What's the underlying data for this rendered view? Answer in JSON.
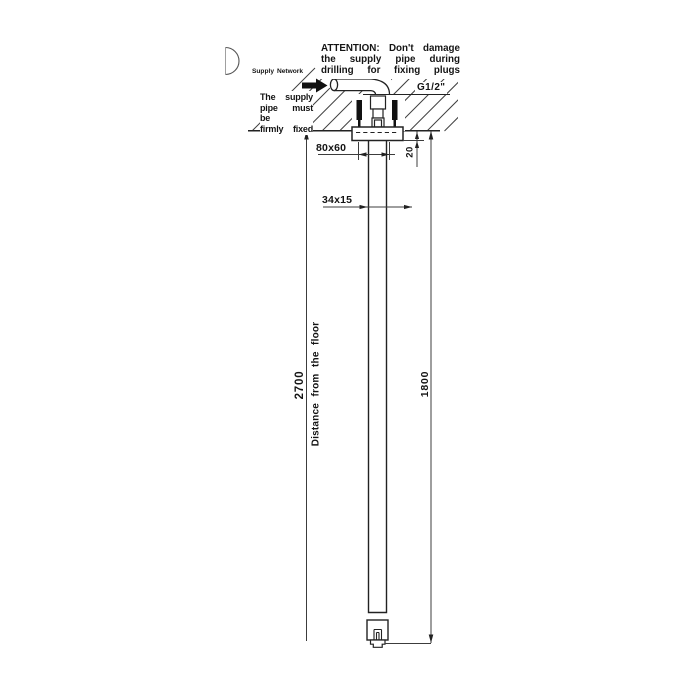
{
  "drawing": {
    "attention": {
      "line1": "ATTENTION: Don't damage",
      "line2": "the supply pipe during",
      "line3": "drilling for fixing plugs"
    },
    "supply_network_label": "Supply Network",
    "supply_pipe_note": {
      "line1": "The supply",
      "line2": "pipe must be",
      "line3": "firmly fixed"
    },
    "thread_label": "G1/2\"",
    "dimensions": {
      "plate_size": "80x60",
      "plate_drop": "20",
      "arm_section": "34x15",
      "ceiling_height": "2700",
      "arm_length": "1800",
      "floor_caption": "Distance from the floor"
    }
  }
}
